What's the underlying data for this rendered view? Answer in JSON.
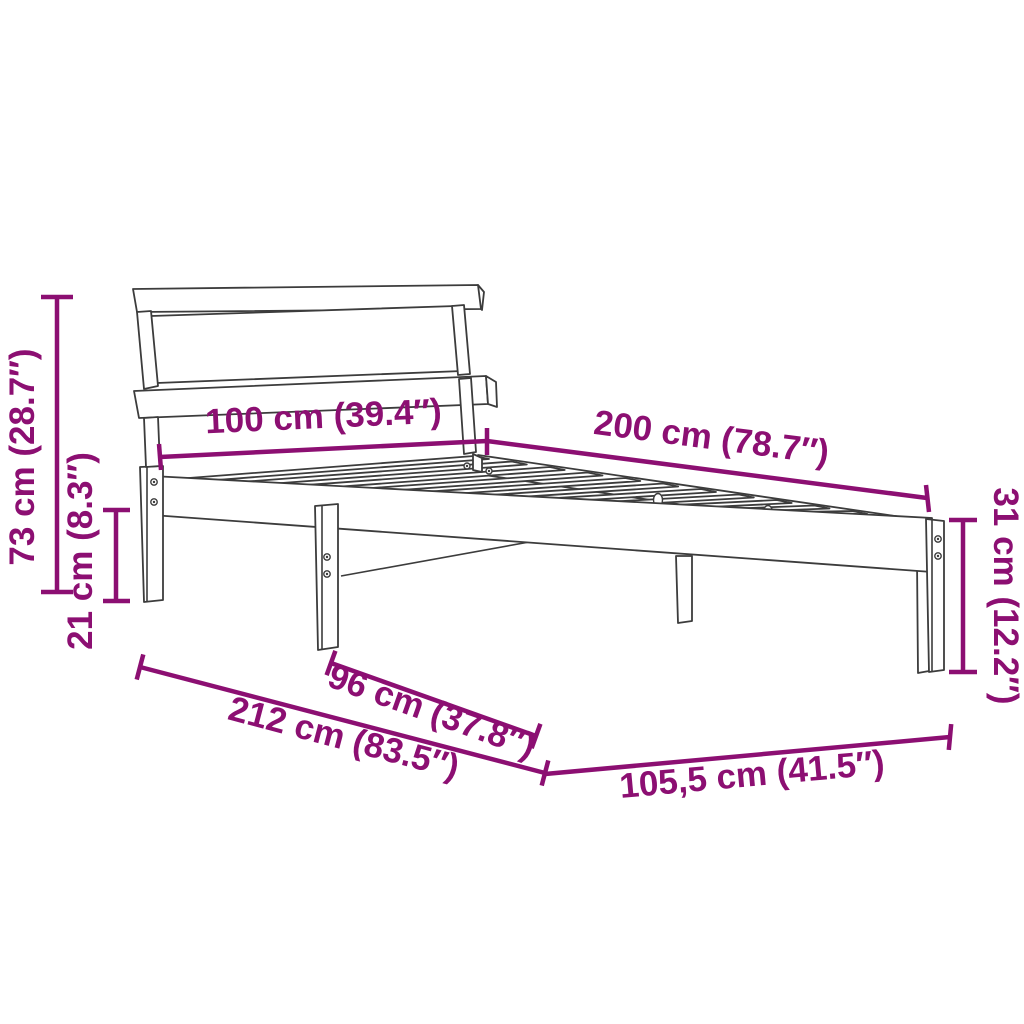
{
  "figure": {
    "subject": "Bed frame with headboard and slatted base - technical dimension diagram",
    "style": "black outline line drawing on white background with magenta dimension annotations"
  },
  "colors": {
    "dimension_accent": "#8C0F72",
    "drawing_outline": "#3C3C3C",
    "background": "#FFFFFF"
  },
  "dimensions": {
    "headboard_height": {
      "label": "73 cm (28.7″)",
      "cm": "73",
      "inches": "28.7"
    },
    "under_bed_clearance": {
      "label": "21 cm (8.3″)",
      "cm": "21",
      "inches": "8.3"
    },
    "bed_width_head": {
      "label": "100 cm (39.4″)",
      "cm": "100",
      "inches": "39.4"
    },
    "bed_length": {
      "label": "200 cm (78.7″)",
      "cm": "200",
      "inches": "78.7"
    },
    "side_rail_height": {
      "label": "31 cm (12.2″)",
      "cm": "31",
      "inches": "12.2"
    },
    "slat_base_width": {
      "label": "96 cm (37.8″)",
      "cm": "96",
      "inches": "37.8"
    },
    "total_length": {
      "label": "212 cm (83.5″)",
      "cm": "212",
      "inches": "83.5"
    },
    "total_width": {
      "label": "105,5 cm (41.5″)",
      "cm": "105,5",
      "inches": "41.5"
    }
  }
}
